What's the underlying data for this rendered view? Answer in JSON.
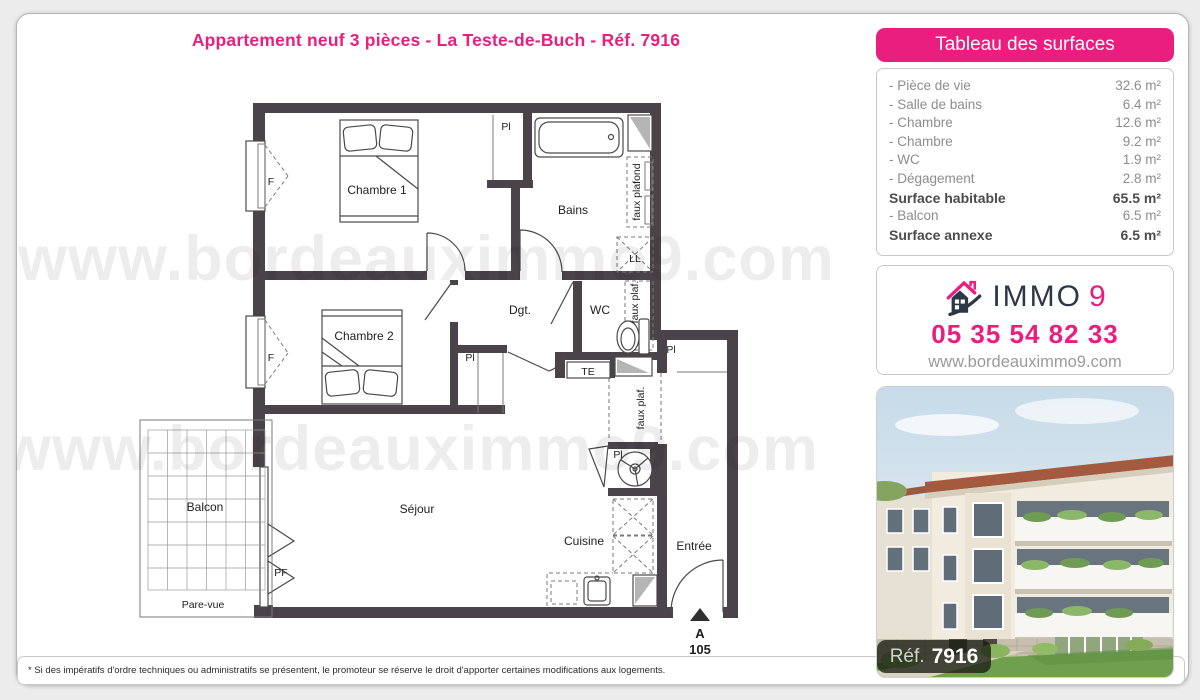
{
  "page": {
    "title": "Appartement neuf 3 pièces - La Teste-de-Buch - Réf. 7916",
    "watermark": "www.bordeauximmo9.com",
    "footer_note": "* Si des impératifs d'ordre techniques ou administratifs se présentent, le promoteur se réserve le droit d'apporter certaines modifications aux logements."
  },
  "colors": {
    "accent_pink": "#e91e7f",
    "brand_navy": "#2b3947",
    "wall_gray": "#4b434a"
  },
  "surfaces_panel": {
    "header": "Tableau des surfaces",
    "rows": [
      {
        "label": "- Pièce de vie",
        "value": "32.6 m²",
        "bold": false
      },
      {
        "label": "- Salle de bains",
        "value": "6.4 m²",
        "bold": false
      },
      {
        "label": "- Chambre",
        "value": "12.6 m²",
        "bold": false
      },
      {
        "label": "- Chambre",
        "value": "9.2 m²",
        "bold": false
      },
      {
        "label": "- WC",
        "value": "1.9 m²",
        "bold": false
      },
      {
        "label": "- Dégagement",
        "value": "2.8 m²",
        "bold": false
      },
      {
        "label": "Surface habitable",
        "value": "65.5 m²",
        "bold": true
      },
      {
        "label": "- Balcon",
        "value": "6.5 m²",
        "bold": false
      },
      {
        "label": "Surface annexe",
        "value": "6.5 m²",
        "bold": true
      }
    ]
  },
  "agency_panel": {
    "brand_word": "IMMO",
    "brand_digit": "9",
    "phone": "05 35 54 82 33",
    "website": "www.bordeauximmo9.com"
  },
  "photo_panel": {
    "ref_label": "Réf.",
    "ref_number": "7916"
  },
  "floor_plan": {
    "labels": {
      "chambre1": "Chambre 1",
      "chambre2": "Chambre 2",
      "bains": "Bains",
      "degagement": "Dgt.",
      "wc": "WC",
      "sejour": "Séjour",
      "cuisine": "Cuisine",
      "entree": "Entrée",
      "balcon": "Balcon",
      "pare_vue": "Pare-vue",
      "placard": "Pl",
      "window": "F",
      "french_door": "PF",
      "washer": "LL",
      "electrical": "TE",
      "false_ceiling_full": "faux plafond",
      "false_ceiling_abbr": "faux plaf.",
      "entry_letter": "A",
      "unit_number": "105"
    }
  }
}
